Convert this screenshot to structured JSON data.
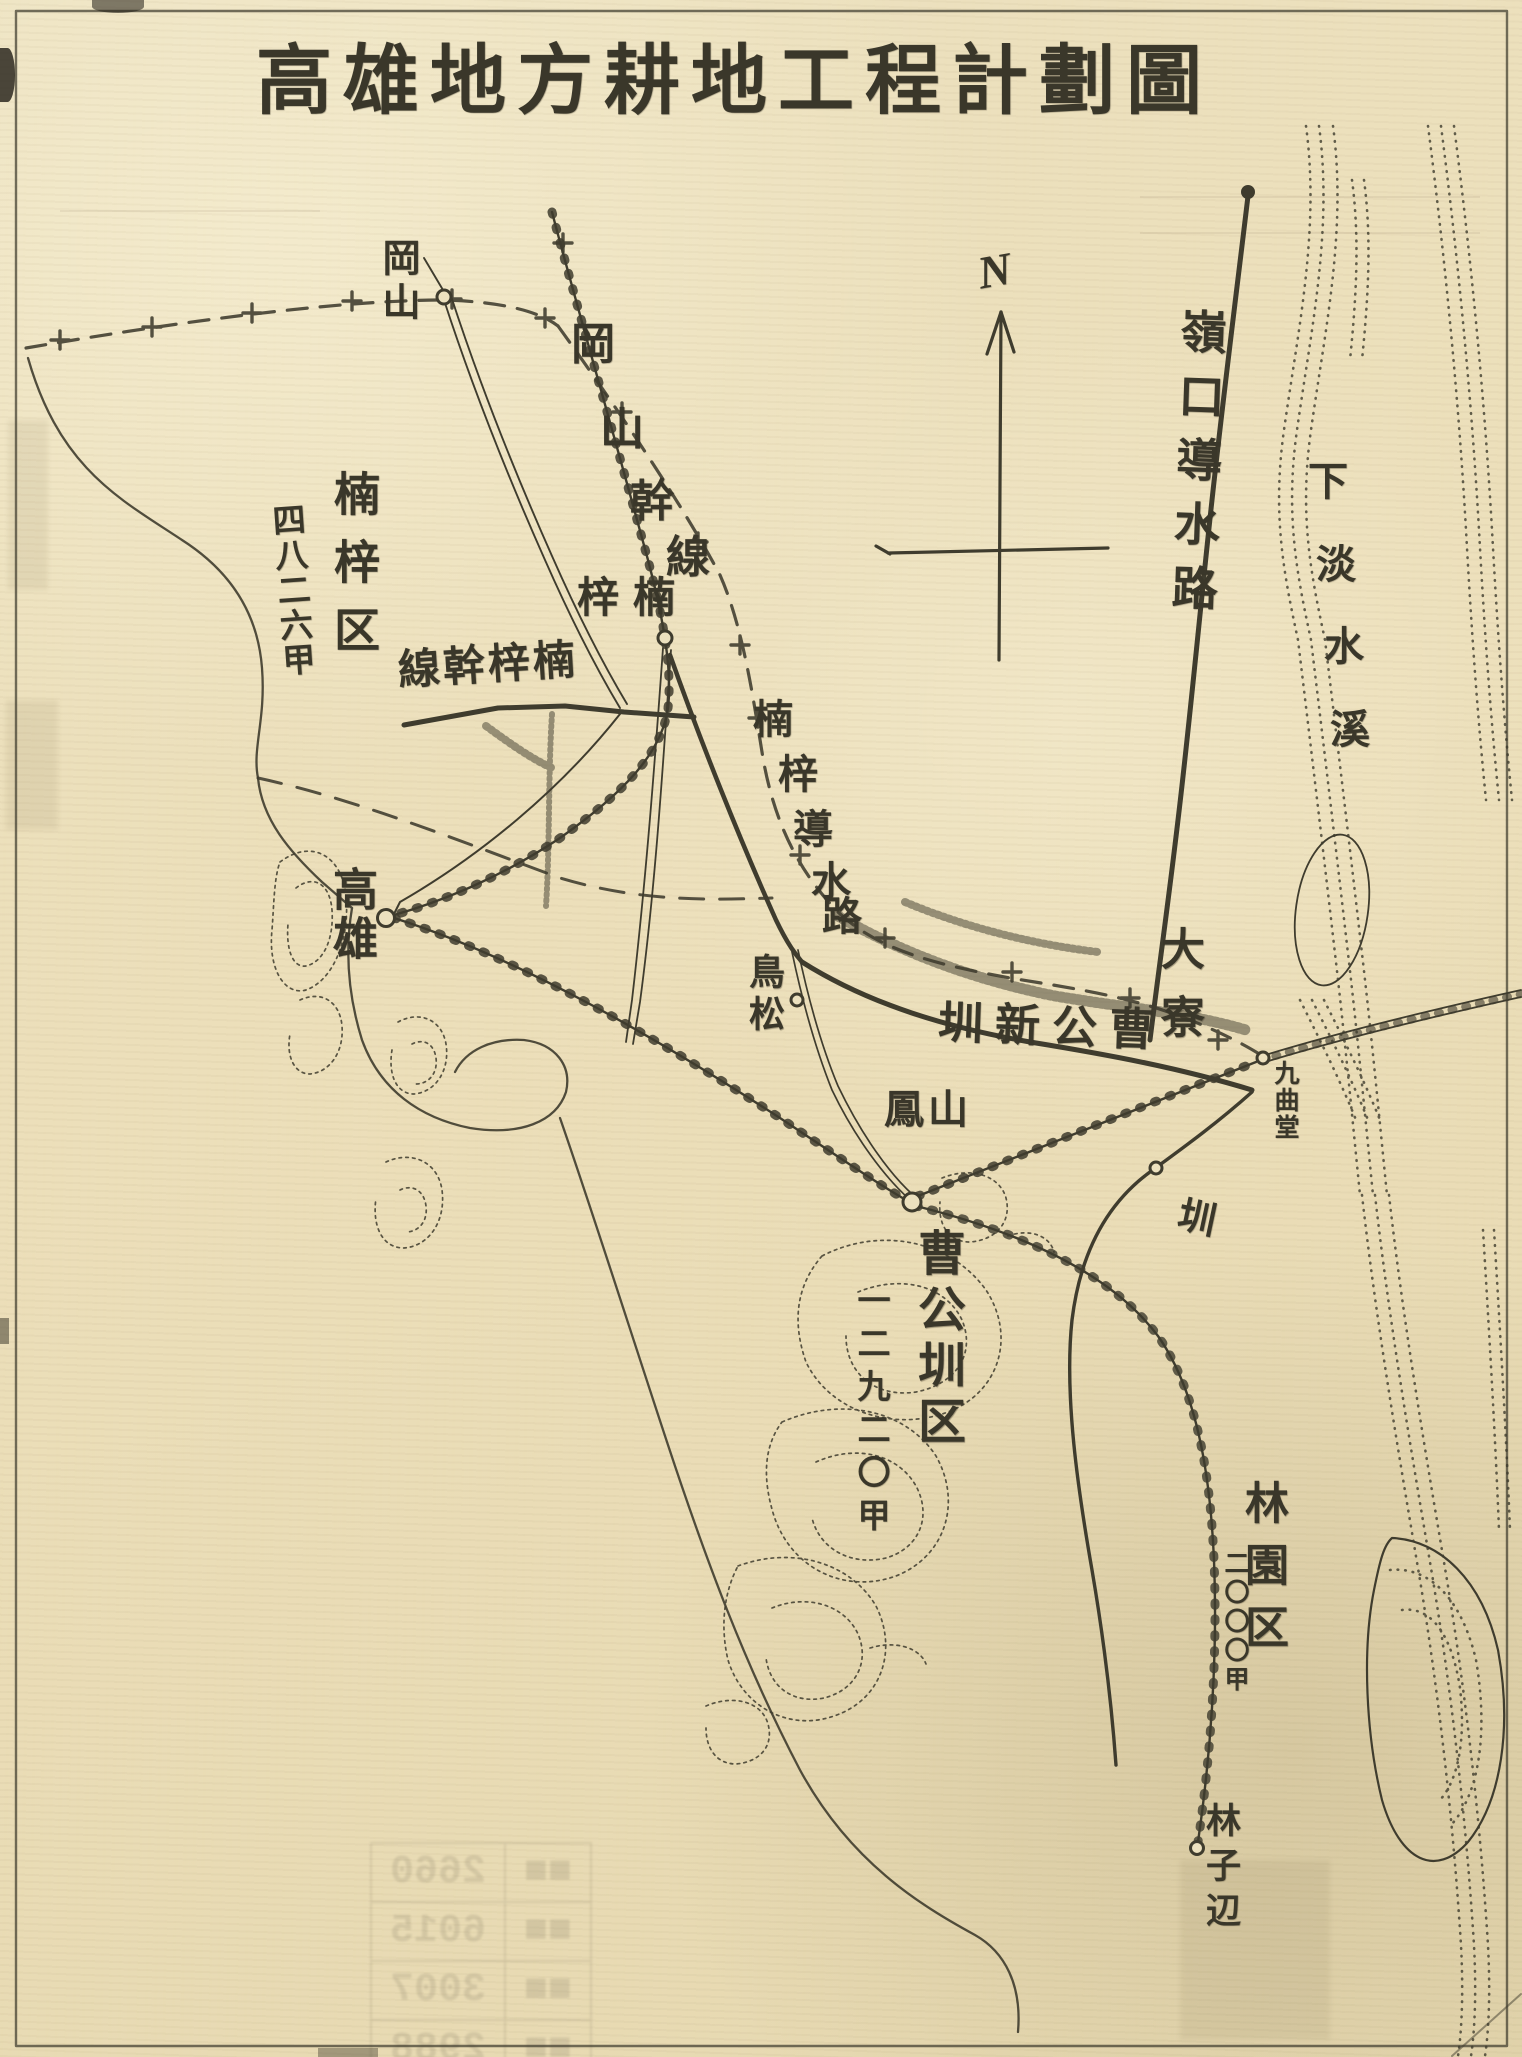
{
  "page": {
    "title": "高雄地方耕地工程計劃圖",
    "compass_label": "N"
  },
  "regions": {
    "nanzi": {
      "name": "楠梓区",
      "area": "四八二六甲"
    },
    "soko": {
      "name": "曹公圳区",
      "area": "一二九二〇甲"
    },
    "ringen": {
      "name": "林園区",
      "area": "二〇〇〇甲"
    }
  },
  "waterways": {
    "reiko": {
      "text": "嶺口導水路"
    },
    "okayama_kansen": {
      "chars": [
        "岡",
        "山",
        "幹",
        "線"
      ],
      "reads": "岡山幹線"
    },
    "nanzi_kansen": {
      "text": "線幹梓楠",
      "reads": "楠梓幹線"
    },
    "nanzi_dosuiro": {
      "chars": [
        "楠",
        "梓",
        "導",
        "水",
        "路"
      ],
      "reads": "楠梓導水路"
    },
    "soko_shin": {
      "text": "圳新公曹",
      "reads": "曹公新圳"
    },
    "tairyo": {
      "upper": "大寮",
      "lower": "圳",
      "reads": "大寮圳"
    }
  },
  "places": {
    "okayama": "岡山",
    "nanzi_station": {
      "text": "梓楠",
      "reads": "楠梓"
    },
    "torimatsu": "鳥松",
    "takao": "高雄",
    "hozan": "鳳山",
    "kyokudo": "九曲堂",
    "rinshihen": "林子辺"
  },
  "river": {
    "name": "下淡水溪",
    "chars": [
      "下",
      "淡",
      "水",
      "溪"
    ]
  },
  "ghost": {
    "rows": [
      "2660",
      "6015",
      "3007",
      "2988"
    ]
  }
}
